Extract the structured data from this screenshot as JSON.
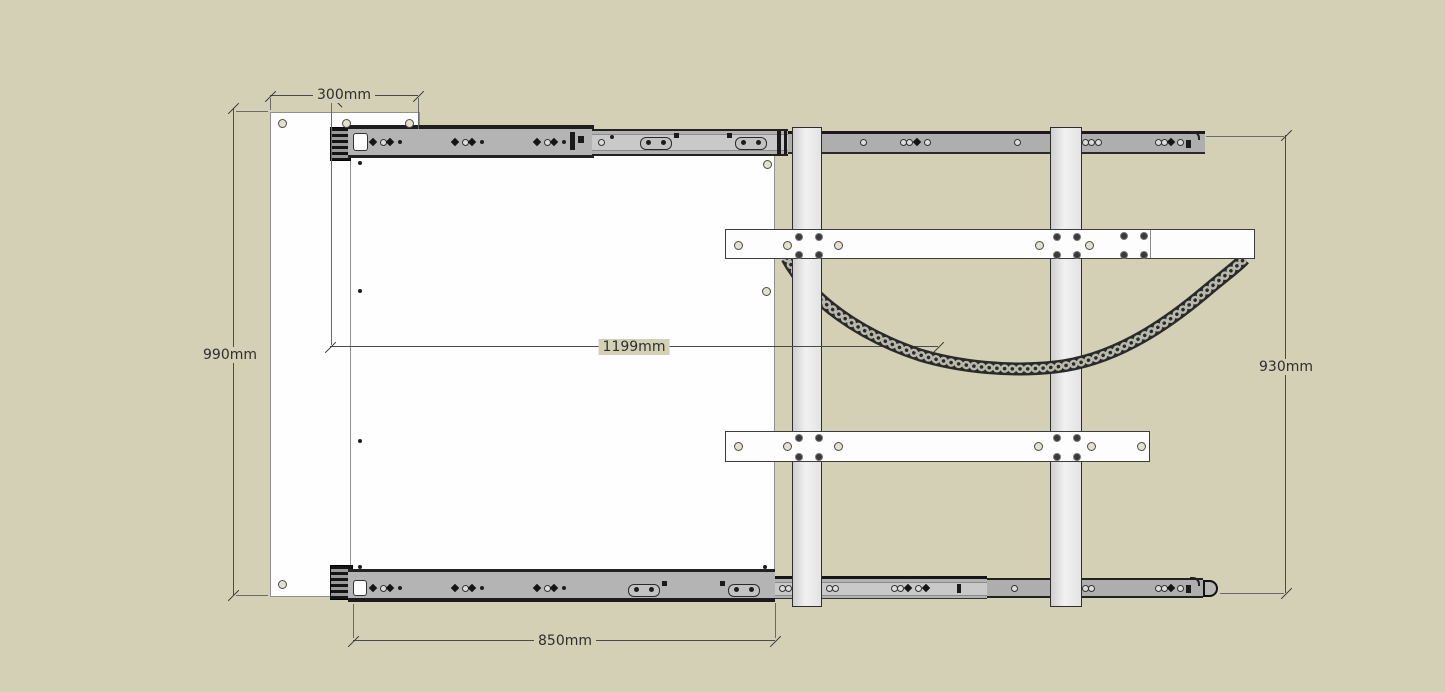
{
  "title": "sliding-tv-mount-technical-drawing",
  "canvas": {
    "width": 1445,
    "height": 692,
    "background": "#d3d0b5"
  },
  "dimensions": {
    "top_offset": {
      "label": "300mm",
      "orientation": "horizontal"
    },
    "left_height": {
      "label": "990mm",
      "orientation": "vertical"
    },
    "mid_width": {
      "label": "1199mm",
      "orientation": "horizontal"
    },
    "bottom_width": {
      "label": "850mm",
      "orientation": "horizontal"
    },
    "right_height": {
      "label": "930mm",
      "orientation": "vertical"
    }
  },
  "components": {
    "back_plate": "wall back plate",
    "sliding_panel": "sliding panel",
    "top_slide": "telescopic drawer slide (top)",
    "bottom_slide": "telescopic drawer slide (bottom)",
    "vertical_bar_left": "vertical mount bar (left)",
    "vertical_bar_right": "vertical mount bar (right)",
    "upper_crossbar": "upper crossbar",
    "lower_crossbar": "lower crossbar",
    "cable_chain": "cable drag chain"
  },
  "colors": {
    "background": "#d3d0b5",
    "panel_white": "#fefefe",
    "rail_gray": "#b4b4b4",
    "rail_dark_edge": "#1e1e1e",
    "chain_dark": "#2a2a2a",
    "chain_link": "#b9b9ab",
    "dimension_text": "#2e2e2e"
  }
}
